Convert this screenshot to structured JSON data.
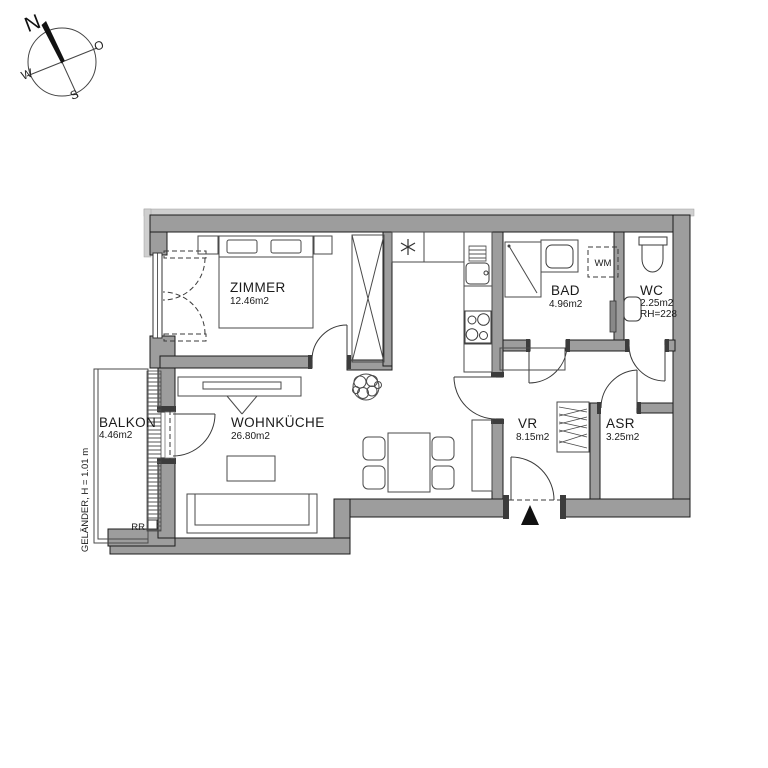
{
  "compass": {
    "north": "N",
    "east": "O",
    "south": "S",
    "west": "W"
  },
  "rooms": [
    {
      "name": "ZIMMER",
      "area": "12.46m2"
    },
    {
      "name": "WOHNKÜCHE",
      "area": "26.80m2"
    },
    {
      "name": "BALKON",
      "area": "4.46m2"
    },
    {
      "name": "BAD",
      "area": "4.96m2"
    },
    {
      "name": "WC",
      "area": "2.25m2",
      "room_height": "RH=228"
    },
    {
      "name": "VR",
      "area": "8.15m2"
    },
    {
      "name": "ASR",
      "area": "3.25m2"
    }
  ],
  "annotations": {
    "washing_machine": "WM",
    "rain_pipe": "RR",
    "railing": "GELÄNDER, H = 1.01 m"
  },
  "colors": {
    "wall_fill": "#9d9d9d",
    "wall_outline": "#1c1c1c",
    "furniture_line": "#4a4a4a",
    "background": "#ffffff"
  }
}
